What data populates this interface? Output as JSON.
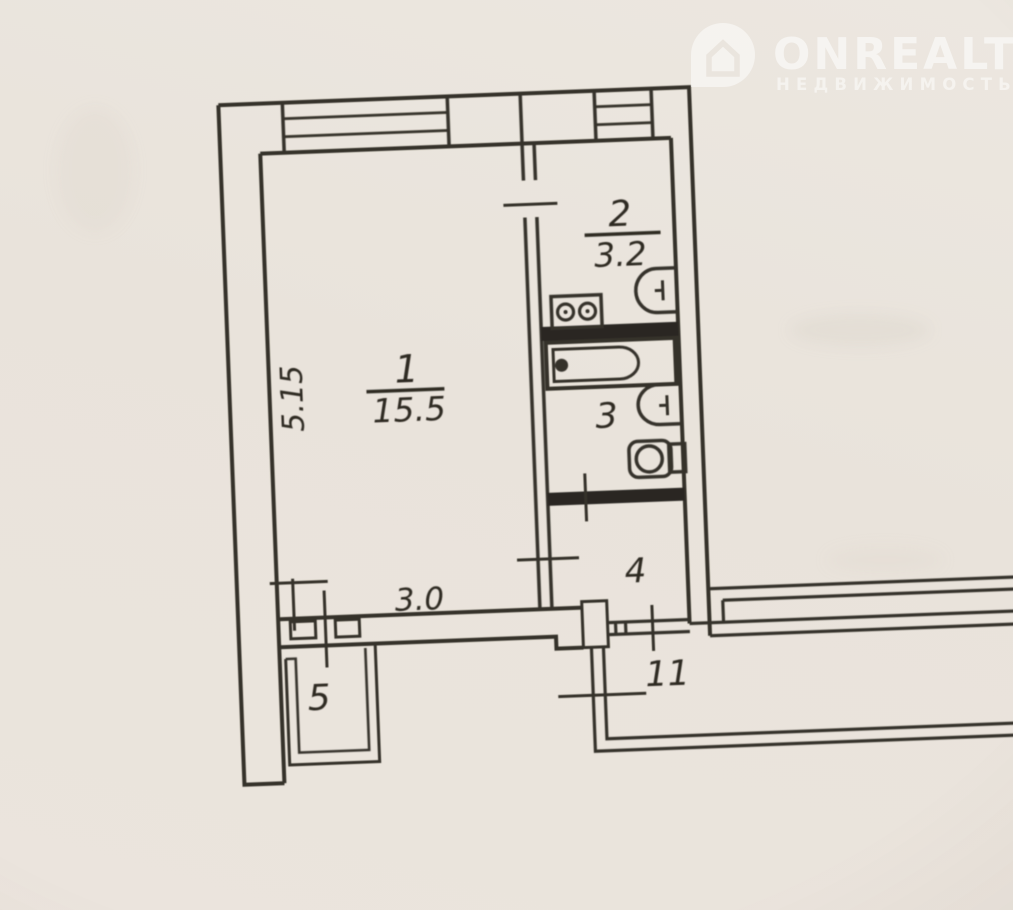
{
  "watermark": {
    "brand": "ONREALT",
    "subtitle": "НЕДВИЖИМОСТЬ",
    "icon": "house-location-pin-icon",
    "color": "#ffffff"
  },
  "plan": {
    "line_color": "#34302a",
    "paper_color": "#e9e4dc",
    "rooms": {
      "living": {
        "number": "1",
        "area": "15.5"
      },
      "kitchen": {
        "number": "2",
        "area": "3.2"
      },
      "bathroom": {
        "number": "3"
      },
      "hall": {
        "number": "4"
      },
      "balcony": {
        "number": "5"
      },
      "corridor": {
        "number": "11"
      }
    },
    "dimensions": {
      "living_width": "3.0",
      "living_depth": "5.15"
    },
    "fixtures": [
      "stove-icon",
      "kitchen-sink-icon",
      "bathtub-icon",
      "washbasin-icon",
      "toilet-icon"
    ]
  }
}
